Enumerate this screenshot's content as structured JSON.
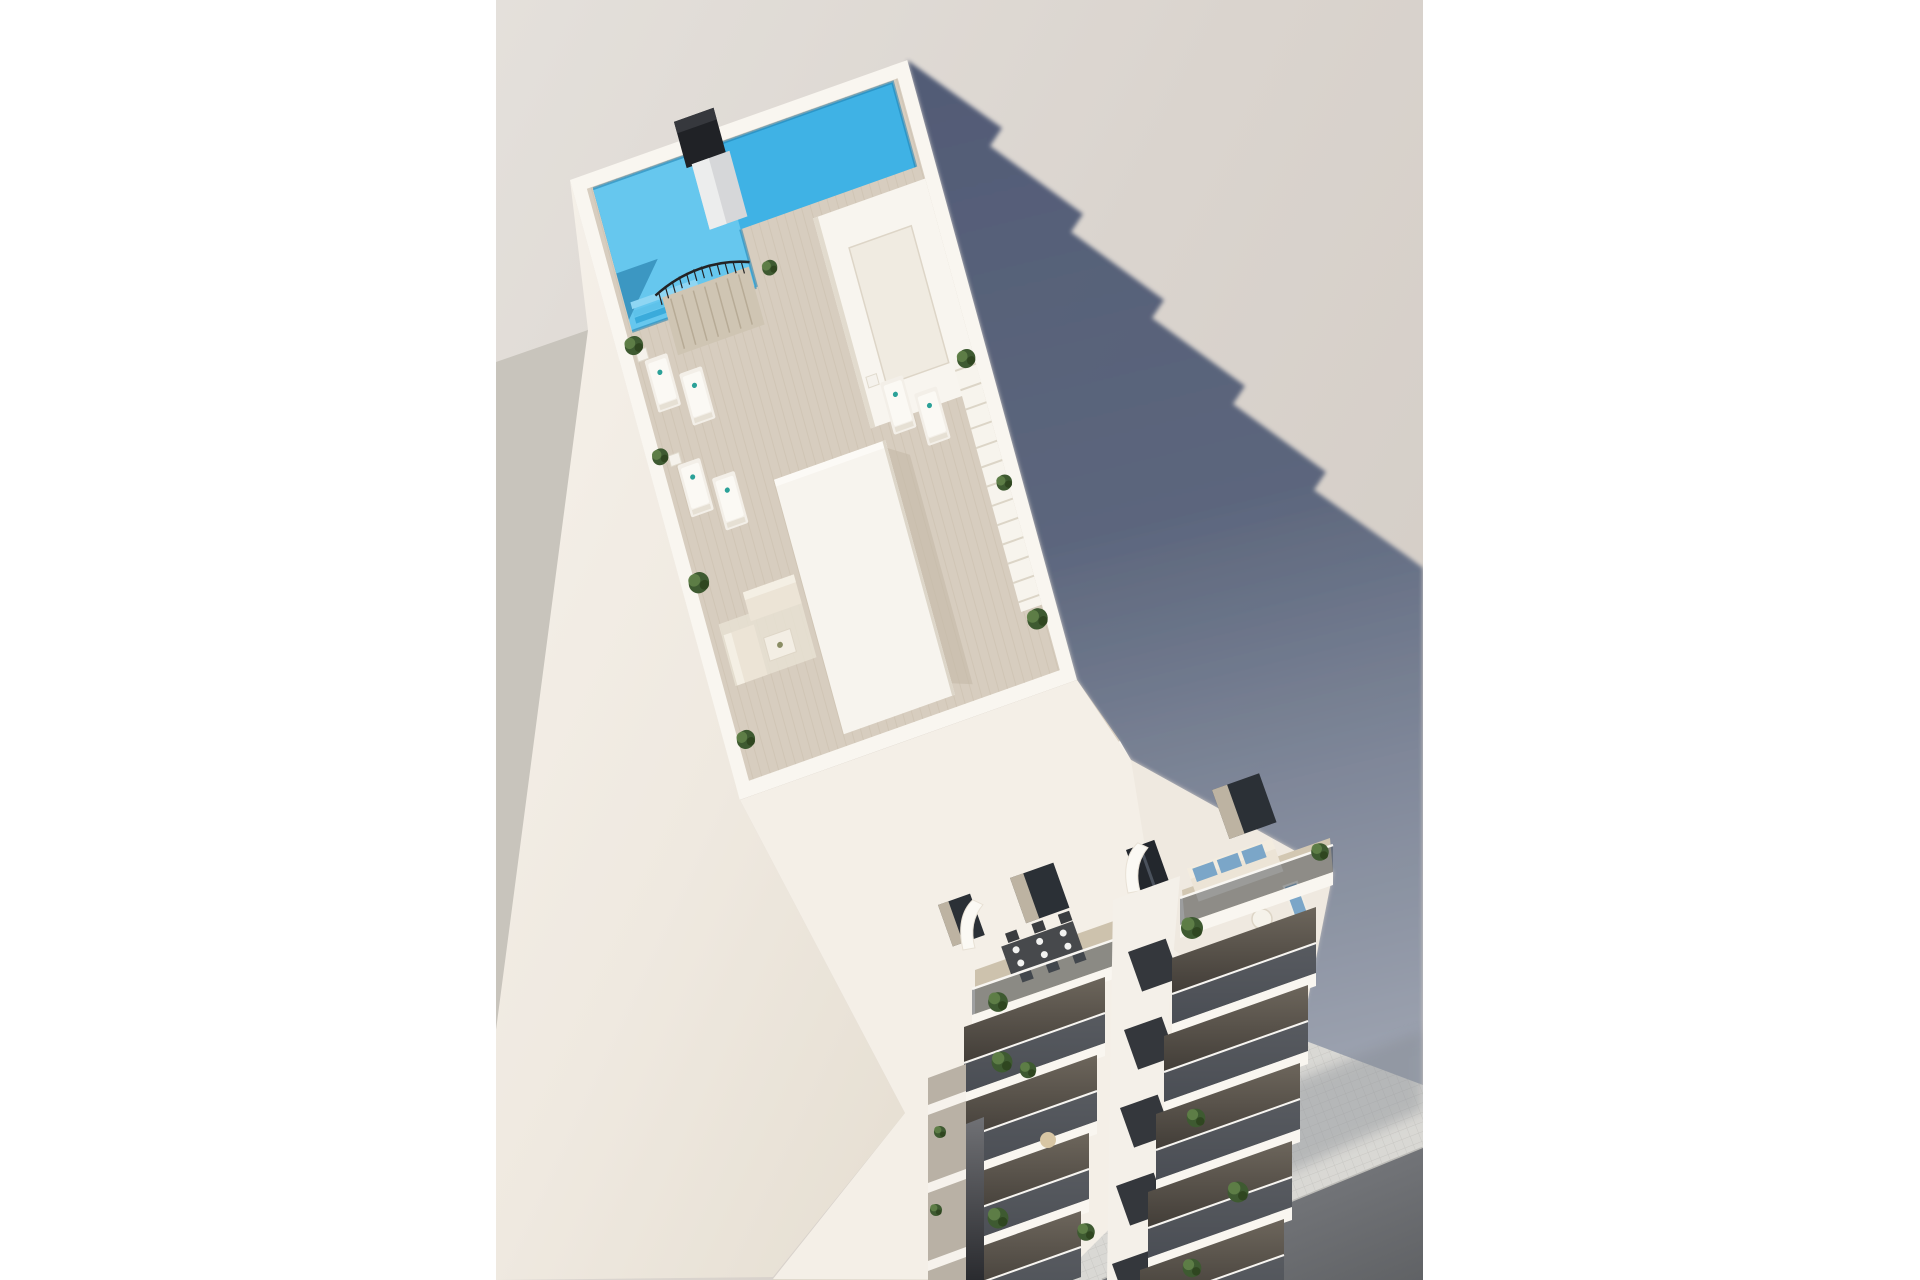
{
  "image": {
    "type": "3d-architectural-render",
    "subject": "aerial view of a modern white apartment tower with rooftop pool terrace, sun deck, penthouse terraces and stacked balconies over a tiled sidewalk",
    "layout": "portrait render centered on a white canvas with white side margins"
  },
  "canvas": {
    "width": 1920,
    "height": 1280,
    "photo_left": 496,
    "photo_right": 1423
  },
  "palette": {
    "margin_white": "#ffffff",
    "bg_top": "#e3dfda",
    "bg_bottom": "#d5cec7",
    "band_gray": "#c8c4bc",
    "shadow_core": "#4c5672",
    "shadow_ground": "#9aa1af",
    "pool_main": "#3fb2e5",
    "pool_light": "#66c7ee",
    "pool_deep": "#1d7fb0",
    "deck": "#d7cdbf",
    "deck_line": "#c9bdab",
    "slab_white": "#f9f6f0",
    "wall_light": "#f4efe7",
    "wall_shade": "#e9e2d6",
    "wall_fold": "#ded7ca",
    "chimney_dark": "#202226",
    "pillar_gray": "#d6d7d9",
    "plant_dark": "#3e5a31",
    "plant_light": "#5f8048",
    "plant_deep": "#2e441f",
    "glass": "#4a515c",
    "balc_top": "#6d665c",
    "balc_bottom": "#332f2b",
    "floor_tan": "#cdc2ad",
    "sofa_cream": "#ece4d6",
    "cushion_blue": "#7ba6c8",
    "table_dark": "#47494c",
    "sidewalk": "#d9d8d4",
    "sidewalk_line": "#c8c7c3",
    "street": "#77797c",
    "gap_dark": "#2a2b2f",
    "towel_teal": "#2ba198",
    "parasol_tan": "#d8c6a4"
  },
  "scene": {
    "objects": [
      "rooftop swimming pool with shallow wing and steps",
      "black chimney block beside pool",
      "wood-look roof deck",
      "black metal stair railing to roof",
      "white skylight room with inner courtyard",
      "louvered pergola along east parapet",
      "central elevator core block",
      "outdoor lounge sofa set with coffee table",
      "sun loungers with side tables",
      "penthouse set-back terraces with loungers",
      "balcony with dark dining table set for six",
      "balcony with cream sofa and blue cushions, round table and sun pad",
      "two stacked balcony columns with glass balustrades and plants",
      "curved white privacy fins between balconies",
      "tiled sidewalk and asphalt street",
      "long stepped cast shadow on ground"
    ],
    "counts": {
      "roof_loungers": 6,
      "penthouse_loungers": 2,
      "balcony_rows_left_column": 5,
      "balcony_rows_right_column": 6,
      "dining_seats": 6,
      "potted_plants_approx": 22
    }
  }
}
